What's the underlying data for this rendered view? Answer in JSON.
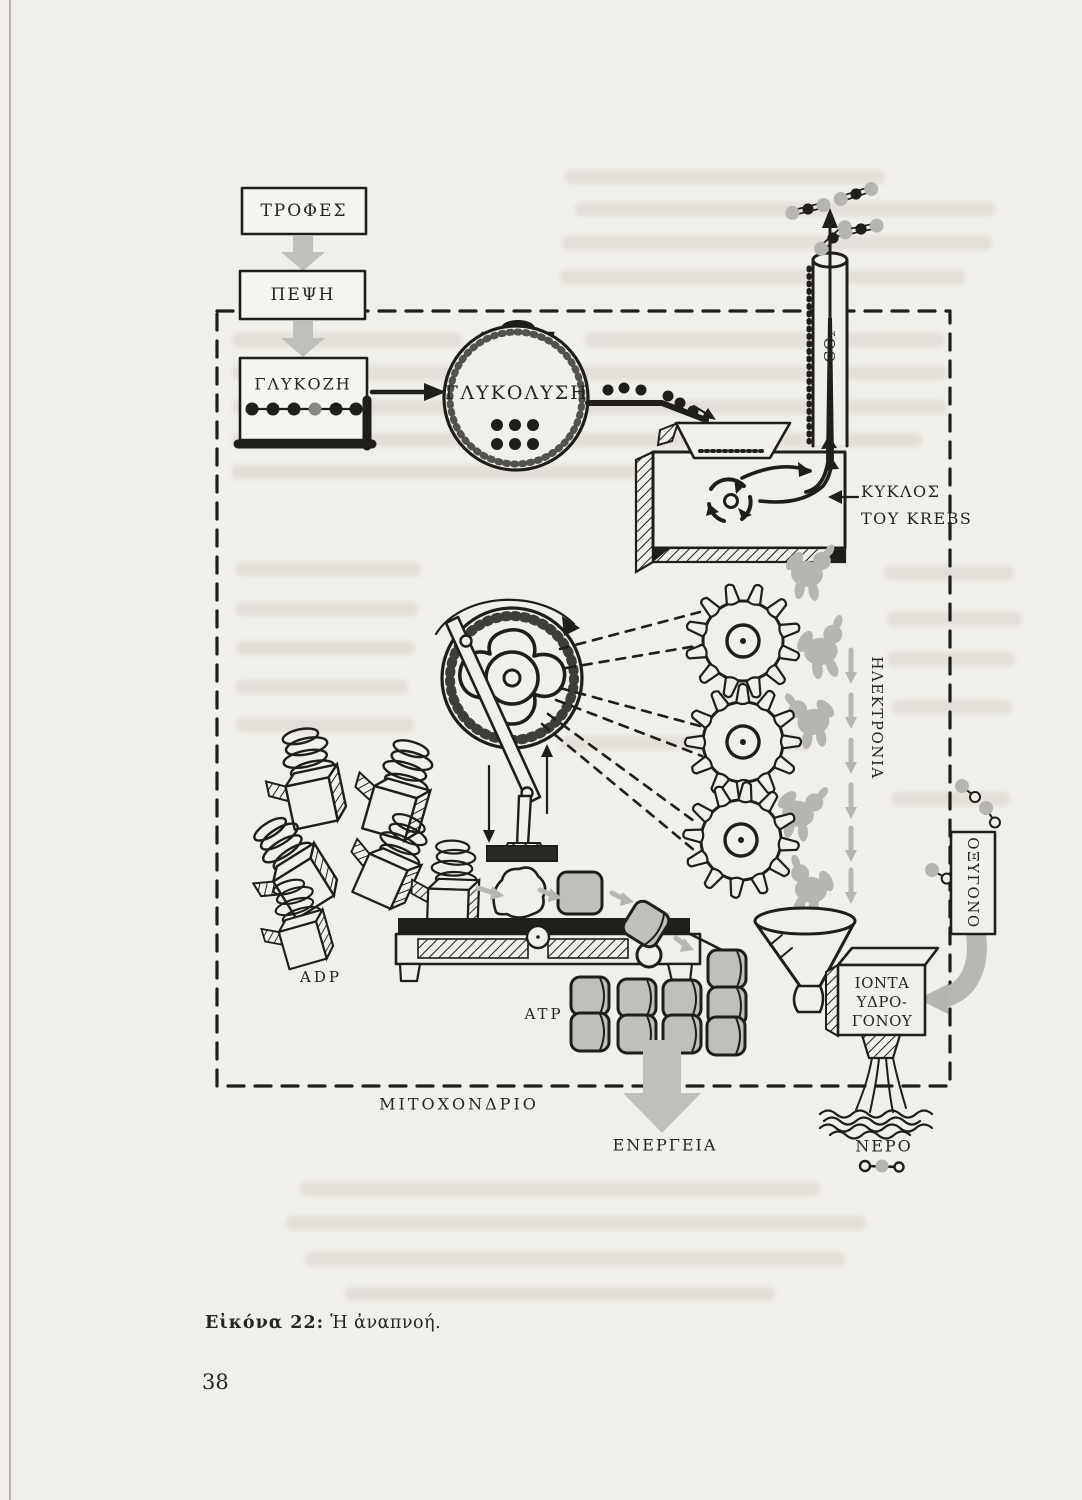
{
  "page_number": "38",
  "caption": {
    "label": "Εἰκόνα 22:",
    "title": "Ἡ ἀναπνοή."
  },
  "labels": {
    "foods": "ΤΡΟΦΕΣ",
    "digestion": "ΠΕΨΗ",
    "glucose": "ΓΛΥΚΟΖΗ",
    "glycolysis": "ΓΛΥΚΟΛΥΣΗ",
    "co2": "CO₂",
    "krebs_line1": "ΚΥΚΛΟΣ",
    "krebs_line2": "ΤΟΥ KREBS",
    "electrons": "ΗΛΕΚΤΡΟΝΙΑ",
    "oxygen": "ΟΞΥΓΟΝΟ",
    "adp": "ADP",
    "atp": "ATP",
    "hydrogen_ions_line1": "ΙΟΝΤΑ",
    "hydrogen_ions_line2": "ΥΔΡΟ-",
    "hydrogen_ions_line3": "ΓΟΝΟΥ",
    "mitochondrion": "ΜΙΤΟΧΟΝΔΡΙΟ",
    "energy": "ΕΝΕΡΓΕΙΑ",
    "water": "ΝΕΡΟ"
  },
  "colors": {
    "paper": "#f1efe9",
    "ink": "#1f1e1a",
    "gray_accent": "#c1bfba"
  }
}
